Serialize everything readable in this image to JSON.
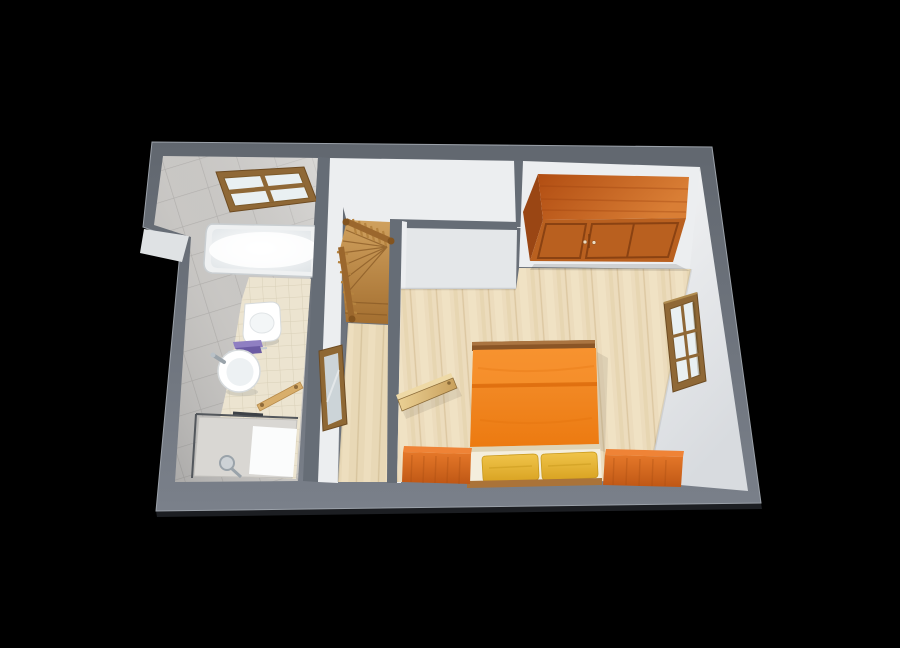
{
  "scene": {
    "title": "3D floor plan render",
    "view": "top-down perspective",
    "background": "#000000"
  },
  "rooms": {
    "bathroom": {
      "name": "Bathroom",
      "furniture": [
        "bathtub",
        "window",
        "wall-hung-toilet",
        "towel-shelf",
        "washbasin",
        "towel-rail",
        "walk-in-shower"
      ]
    },
    "hallway": {
      "name": "Hallway",
      "furniture": [
        "winder-staircase",
        "stair-railing",
        "leaning-wall-mirror",
        "open-door"
      ]
    },
    "bedroom": {
      "name": "Bedroom",
      "furniture": [
        "wardrobe",
        "double-bed",
        "pillow-left",
        "pillow-right",
        "nightstand-left",
        "nightstand-right",
        "casement-window"
      ]
    }
  },
  "colors": {
    "background": "#000000",
    "wall_top_dark": "#61676f",
    "wall_top_light": "#7a808a",
    "wall_interior": "#666d76",
    "wall_face": "#eceef0",
    "wall_face_shaded": "#e4e7e9",
    "wall_face_bright": "#f3f4f5",
    "wall_face_dim": "#d8dbdf",
    "edge_highlight": "#9ba1a9",
    "under_shadow": "#1c1e22",
    "tile_wall": "#cbc9c6",
    "tile_grout": "#b2b0ad",
    "bath_floor": "#ece4d0",
    "bath_floor_grout": "#d9d0b8",
    "hall_wood": "#e8d8b6",
    "hall_wood_line": "#d2bd95",
    "bedroom_wood": "#ecdcbd",
    "bedroom_wood_line": "#d8c29a",
    "stair_wood_light": "#d0a15e",
    "stair_wood_dark": "#a46f30",
    "stair_step_line": "#8a5b26",
    "stair_rail": "#9b672d",
    "stair_baluster": "#b5833f",
    "window_frame": "#8f6836",
    "window_frame_dark": "#6d4b22",
    "window_glass": "#e9f0f2",
    "tub_rim": "#eff1f2",
    "fixture_white": "#ffffff",
    "fixture_stroke": "#d6dadc",
    "shower_tray": "#d9d7d3",
    "shower_panel": "#fbfcfc",
    "shower_glass_line": "#53575c",
    "chrome": "#9aa3aa",
    "towel_purple_light": "#8f7fc2",
    "towel_purple_dark": "#6b5ba3",
    "towel_bar_wood": "#d8ae6b",
    "mirror_frame": "#8f6834",
    "mirror_glass": "#ccd4d8",
    "door_wood_light": "#eed9a6",
    "door_wood_grad_a": "#ead094",
    "door_wood_grad_b": "#c9a05c",
    "door_outline": "#8a6a38",
    "wardrobe_top_dark": "#b14d12",
    "wardrobe_top_light": "#d97e35",
    "wardrobe_front": "#b9601f",
    "wardrobe_side": "#9a4614",
    "wardrobe_line": "#8a4212",
    "wardrobe_handle": "#ecdcc0",
    "bed_frame": "#8a5526",
    "bed_frame_light": "#aa7440",
    "duvet_light": "#f59130",
    "duvet": "#ec7a10",
    "duvet_fold": "#d96608",
    "sheet": "#f4eedd",
    "pillow_light": "#f0c44a",
    "pillow_dark": "#d9a322",
    "pillow_line": "#c8991c",
    "nightstand_top": "#ef8336",
    "nightstand_light": "#e57829",
    "nightstand_dark": "#bf5715",
    "nightstand_line": "#a84e12",
    "foot_bar": "#aa7339"
  }
}
